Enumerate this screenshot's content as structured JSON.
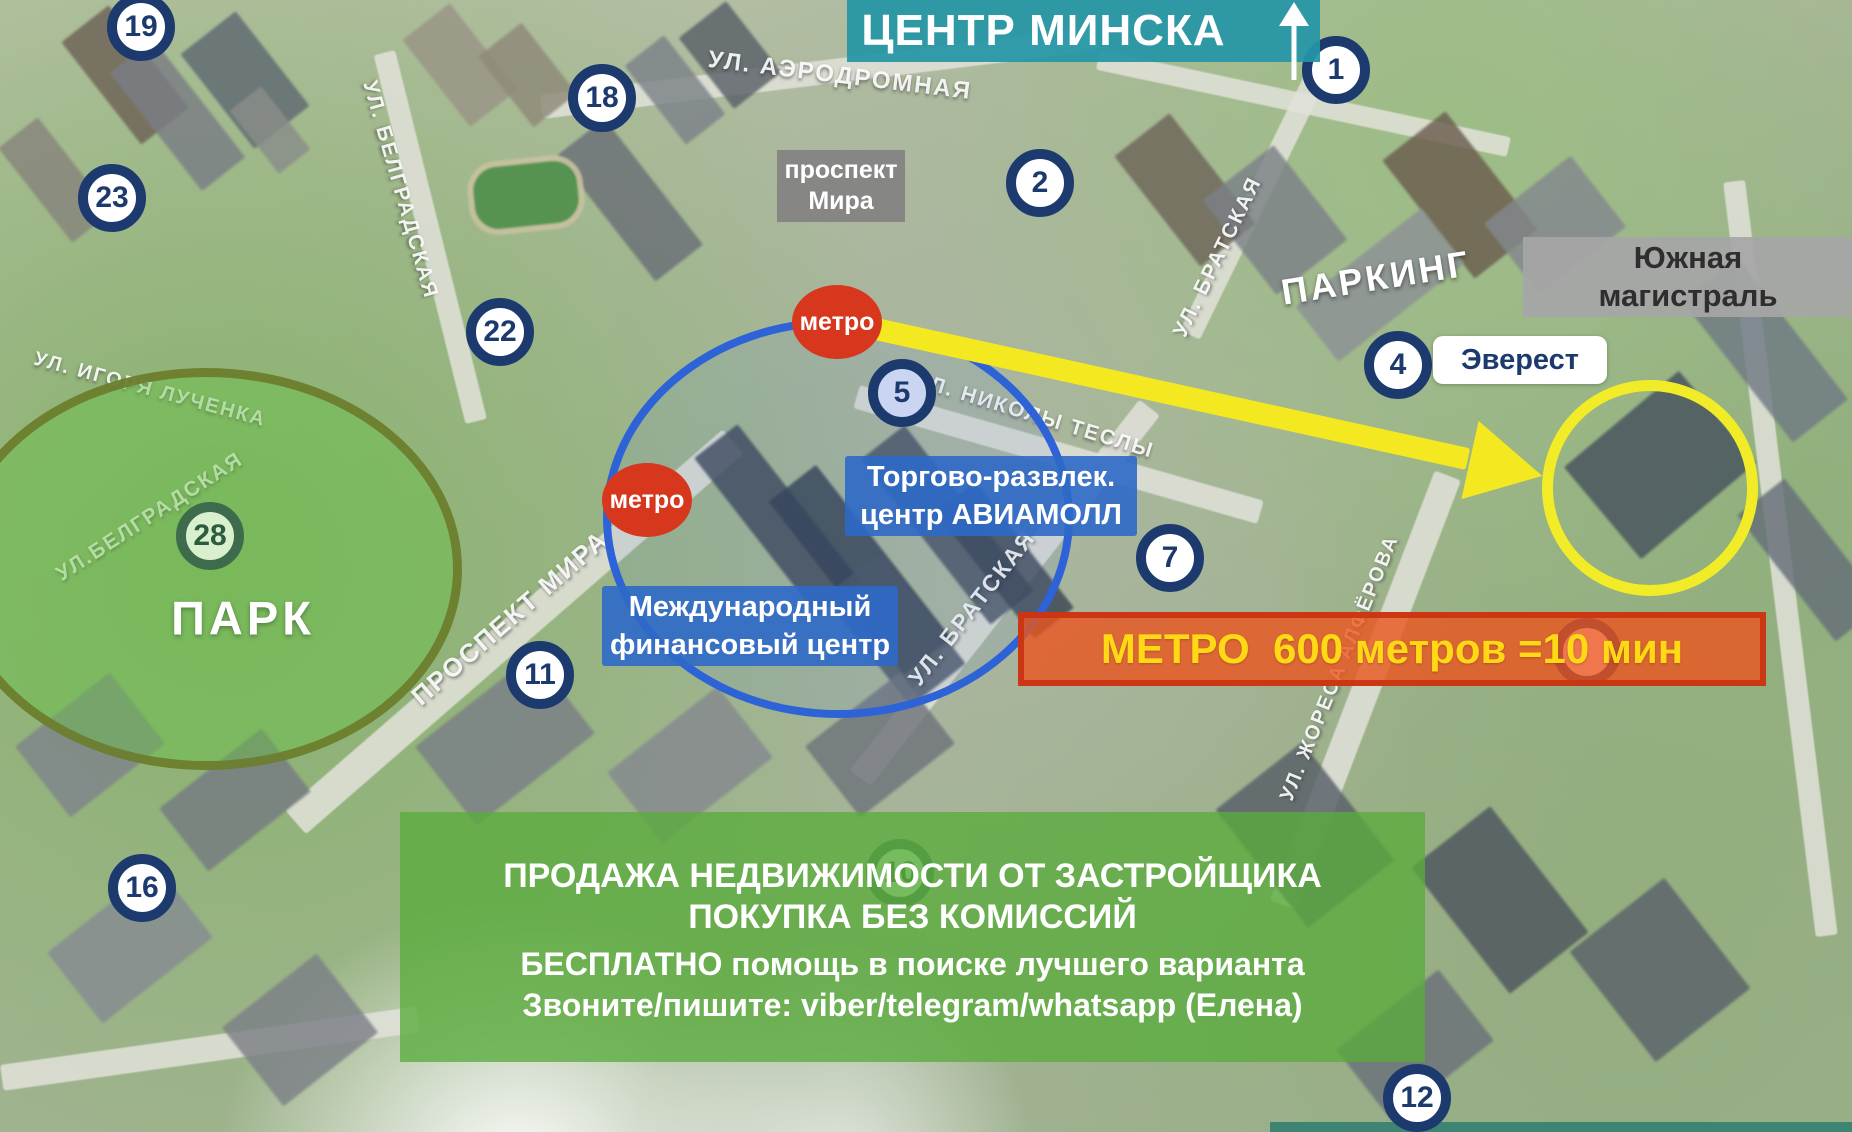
{
  "map": {
    "city_center_banner": {
      "text": "ЦЕНТР МИНСКА"
    },
    "boxes": {
      "prospekt_mira": {
        "line1": "проспект",
        "line2": "Мира"
      },
      "south_highway": {
        "line1": "Южная",
        "line2": "магистраль"
      },
      "everest": "Эверест",
      "park": "ПАРК"
    },
    "poi_labels": {
      "aviamall": {
        "line1": "Торгово-развлек.",
        "line2": "центр АВИАМОЛЛ"
      },
      "financial_center": {
        "line1": "Международный",
        "line2": "финансовый центр"
      }
    },
    "metro_badge_label": "метро",
    "metro_badges": [
      {
        "x": 837,
        "y": 322
      },
      {
        "x": 647,
        "y": 500
      }
    ],
    "metro_banner": {
      "text": "МЕТРО  600 метров =10 мин",
      "bg": "#e5551e",
      "text_color": "#ffd915"
    },
    "promo_banner": {
      "lines": [
        "ПРОДАЖА НЕДВИЖИМОСТИ ОТ ЗАСТРОЙЩИКА",
        "ПОКУПКА БЕЗ КОМИССИЙ",
        "БЕСПЛАТНО помощь в поиске лучшего варианта",
        "Звоните/пишите: viber/telegram/whatsapp (Елена)"
      ],
      "bg": "#58aa3c"
    },
    "pins": [
      {
        "number": "19",
        "x": 141,
        "y": 27,
        "variant": "navy"
      },
      {
        "number": "18",
        "x": 602,
        "y": 98,
        "variant": "navy"
      },
      {
        "number": "23",
        "x": 112,
        "y": 198,
        "variant": "navy"
      },
      {
        "number": "22",
        "x": 500,
        "y": 332,
        "variant": "navy"
      },
      {
        "number": "2",
        "x": 1040,
        "y": 183,
        "variant": "navy"
      },
      {
        "number": "1",
        "x": 1336,
        "y": 70,
        "variant": "navy"
      },
      {
        "number": "4",
        "x": 1398,
        "y": 365,
        "variant": "navy"
      },
      {
        "number": "5",
        "x": 902,
        "y": 393,
        "variant": "blue-light"
      },
      {
        "number": "7",
        "x": 1170,
        "y": 558,
        "variant": "navy"
      },
      {
        "number": "11",
        "x": 540,
        "y": 675,
        "variant": "navy"
      },
      {
        "number": "16",
        "x": 142,
        "y": 888,
        "variant": "navy"
      },
      {
        "number": "12",
        "x": 1417,
        "y": 1098,
        "variant": "navy"
      },
      {
        "number": "28",
        "x": 210,
        "y": 536,
        "variant": "green"
      },
      {
        "number": "10",
        "x": 900,
        "y": 873,
        "variant": "green"
      },
      {
        "number": "",
        "x": 1587,
        "y": 652,
        "variant": "navy"
      }
    ],
    "street_labels": [
      {
        "text": "УЛ. АЭРОДРОМНАЯ",
        "x": 840,
        "y": 76,
        "rotate": 7,
        "size": 24,
        "major": false
      },
      {
        "text": "УЛ. БЕЛГРАДСКАЯ",
        "x": 400,
        "y": 190,
        "rotate": 74,
        "size": 21,
        "major": false
      },
      {
        "text": "УЛ.БЕЛГРАДСКАЯ",
        "x": 150,
        "y": 517,
        "rotate": -33,
        "size": 21,
        "major": false
      },
      {
        "text": "УЛ. ИГОРЯ ЛУЧЕНКА",
        "x": 150,
        "y": 390,
        "rotate": 15,
        "size": 20,
        "major": false
      },
      {
        "text": "ПРОСПЕКТ МИРА",
        "x": 510,
        "y": 618,
        "rotate": -41,
        "size": 26,
        "major": false
      },
      {
        "text": "УЛ. БРАТСКАЯ",
        "x": 1218,
        "y": 257,
        "rotate": -64,
        "size": 21,
        "major": false
      },
      {
        "text": "УЛ. БРАТСКАЯ",
        "x": 972,
        "y": 608,
        "rotate": -52,
        "size": 23,
        "major": false
      },
      {
        "text": "УЛ. НИКОЛЫ ТЕСЛЫ",
        "x": 1035,
        "y": 416,
        "rotate": 17,
        "size": 21,
        "major": false
      },
      {
        "text": "УЛ. ЖОРЕСА АЛФЁРОВА",
        "x": 1340,
        "y": 668,
        "rotate": -68,
        "size": 20,
        "major": false
      },
      {
        "text": "ПАРКИНГ",
        "x": 1376,
        "y": 278,
        "rotate": -9,
        "size": 36,
        "major": true
      }
    ],
    "colors": {
      "pin_navy": "#1c3a6e",
      "metro_red": "#d6371d",
      "route_yellow": "#f4e821",
      "park_green": "#68c048",
      "center_blue": "#2e63d8",
      "banner_teal": "#2596a6"
    }
  }
}
